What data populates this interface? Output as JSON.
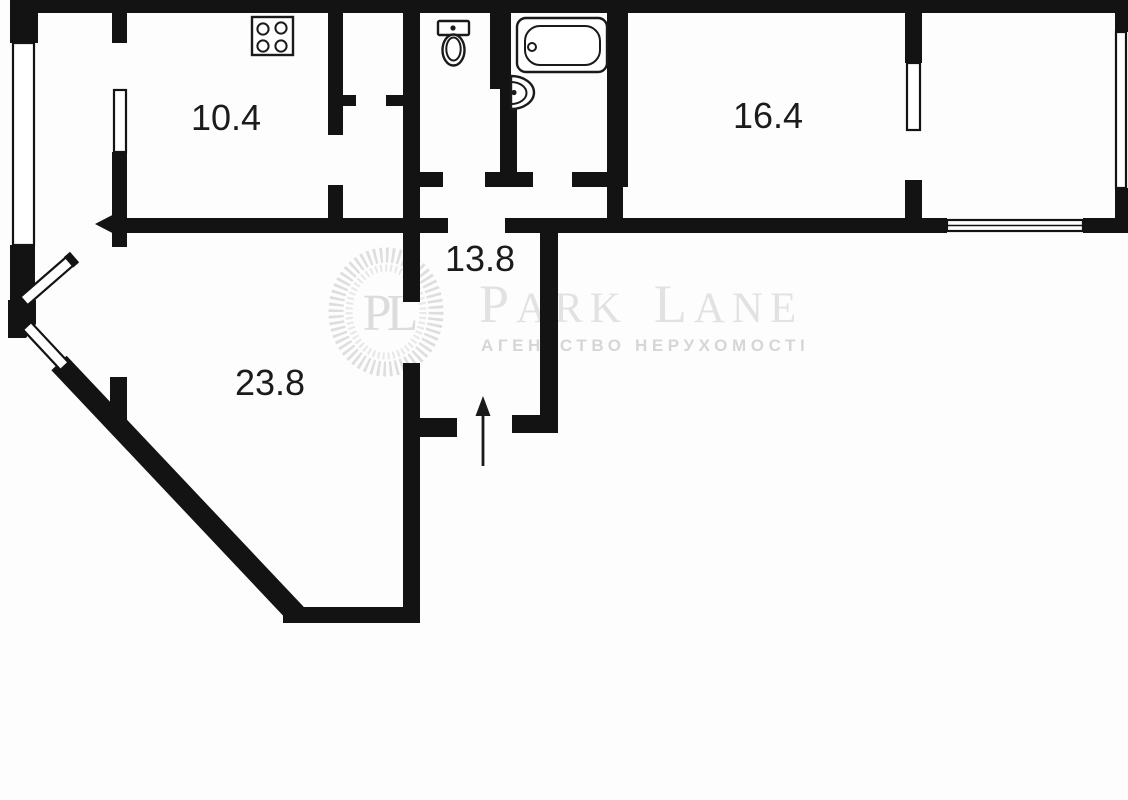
{
  "plan": {
    "type": "apartment-floor-plan",
    "rooms": [
      {
        "id": "kitchen",
        "area_label": "10.4"
      },
      {
        "id": "room-right",
        "area_label": "16.4"
      },
      {
        "id": "hallway",
        "area_label": "13.8"
      },
      {
        "id": "living-room",
        "area_label": "23.8"
      }
    ],
    "fixtures": [
      "stove-icon",
      "toilet-icon",
      "bathtub-icon",
      "sink-icon"
    ],
    "symbols": [
      "entrance-arrow-up",
      "door-arrow-left",
      "window-double-line"
    ],
    "colors": {
      "wall": "#131313",
      "label": "#1b1b1b",
      "background": "#fdfdfd"
    }
  },
  "watermark": {
    "monogram": "PL",
    "brand_parts": {
      "p": "P",
      "ark": "ARK",
      "l": "L",
      "ane": "ANE"
    },
    "subtitle": "АГЕНТСТВО НЕРУХОМОСТІ",
    "color": "#e2e2e2"
  }
}
